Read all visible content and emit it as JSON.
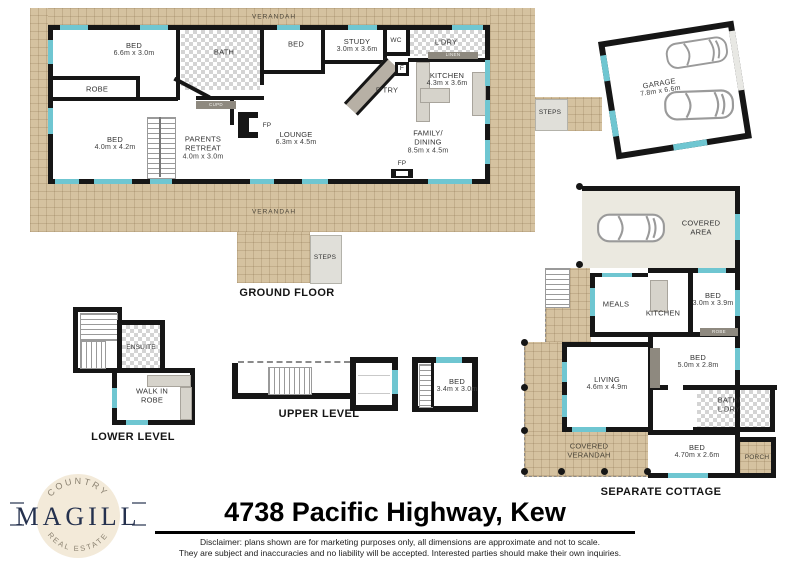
{
  "address": "4738 Pacific Highway, Kew",
  "disclaimer": {
    "line1": "Disclaimer: plans shown are for marketing purposes only, all dimensions are approximate and not to scale.",
    "line2": "They are subject and inaccuracies and no liability will be accepted.  Interested parties should make their own inquiries."
  },
  "logo": {
    "brand": "MAGILL",
    "arc_top": "COUNTRY",
    "arc_bottom": "REAL ESTATE"
  },
  "colors": {
    "verandah_tan": "#d5c2a0",
    "window_teal": "#6fc6d1",
    "wall_black": "#161616",
    "logo_navy": "#25314e",
    "logo_cream": "#f3ead9"
  },
  "ground_floor": {
    "label": "GROUND FLOOR",
    "verandah_top": "VERANDAH",
    "verandah_bottom": "VERANDAH",
    "steps_bottom": "STEPS",
    "steps_right": "STEPS",
    "rooms": {
      "bed1": {
        "name": "BED",
        "dims": "6.6m x 3.0m"
      },
      "robe": {
        "name": "ROBE"
      },
      "bath": {
        "name": "BATH"
      },
      "bed3": {
        "name": "BED"
      },
      "study": {
        "name": "STUDY",
        "dims": "3.0m x 3.6m"
      },
      "wc": {
        "name": "WC"
      },
      "ldry": {
        "name": "L'DRY"
      },
      "linen": {
        "name": "LINEN"
      },
      "fridge": {
        "name": "F"
      },
      "ptry": {
        "name": "P'TRY"
      },
      "kitchen": {
        "name": "KITCHEN",
        "dims": "4.3m x 3.6m"
      },
      "cupd": {
        "name": "CUPD"
      },
      "bed2": {
        "name": "BED",
        "dims": "4.0m x 4.2m"
      },
      "parents": {
        "name": "PARENTS RETREAT",
        "dims": "4.0m x 3.0m"
      },
      "lounge": {
        "name": "LOUNGE",
        "dims": "6.3m x 4.5m"
      },
      "family": {
        "name": "FAMILY/ DINING",
        "dims": "8.5m x 4.5m"
      },
      "fp1": {
        "name": "FP"
      },
      "fp2": {
        "name": "FP"
      }
    }
  },
  "garage": {
    "name": "GARAGE",
    "dims": "7.8m x 6.6m"
  },
  "lower_level": {
    "label": "LOWER LEVEL",
    "rooms": {
      "ensuite": {
        "name": "ENSUITE"
      },
      "wir": {
        "name": "WALK IN ROBE"
      }
    }
  },
  "upper_level": {
    "label": "UPPER LEVEL",
    "rooms": {
      "bed": {
        "name": "BED",
        "dims": "3.4m x 3.0m"
      }
    }
  },
  "cottage": {
    "label": "SEPARATE COTTAGE",
    "rooms": {
      "covered_area": {
        "name": "COVERED AREA"
      },
      "meals": {
        "name": "MEALS"
      },
      "kitchen": {
        "name": "KITCHEN"
      },
      "bed1": {
        "name": "BED",
        "dims": "3.0m x 3.9m"
      },
      "robe": {
        "name": "ROBE"
      },
      "living": {
        "name": "LIVING",
        "dims": "4.6m x 4.9m"
      },
      "bed2": {
        "name": "BED",
        "dims": "5.0m x 2.8m"
      },
      "bath": {
        "name": "BATH/ L'DRY"
      },
      "bed3": {
        "name": "BED",
        "dims": "4.70m x 2.6m"
      },
      "verandah": {
        "name": "COVERED VERANDAH"
      },
      "porch": {
        "name": "PORCH"
      }
    }
  }
}
